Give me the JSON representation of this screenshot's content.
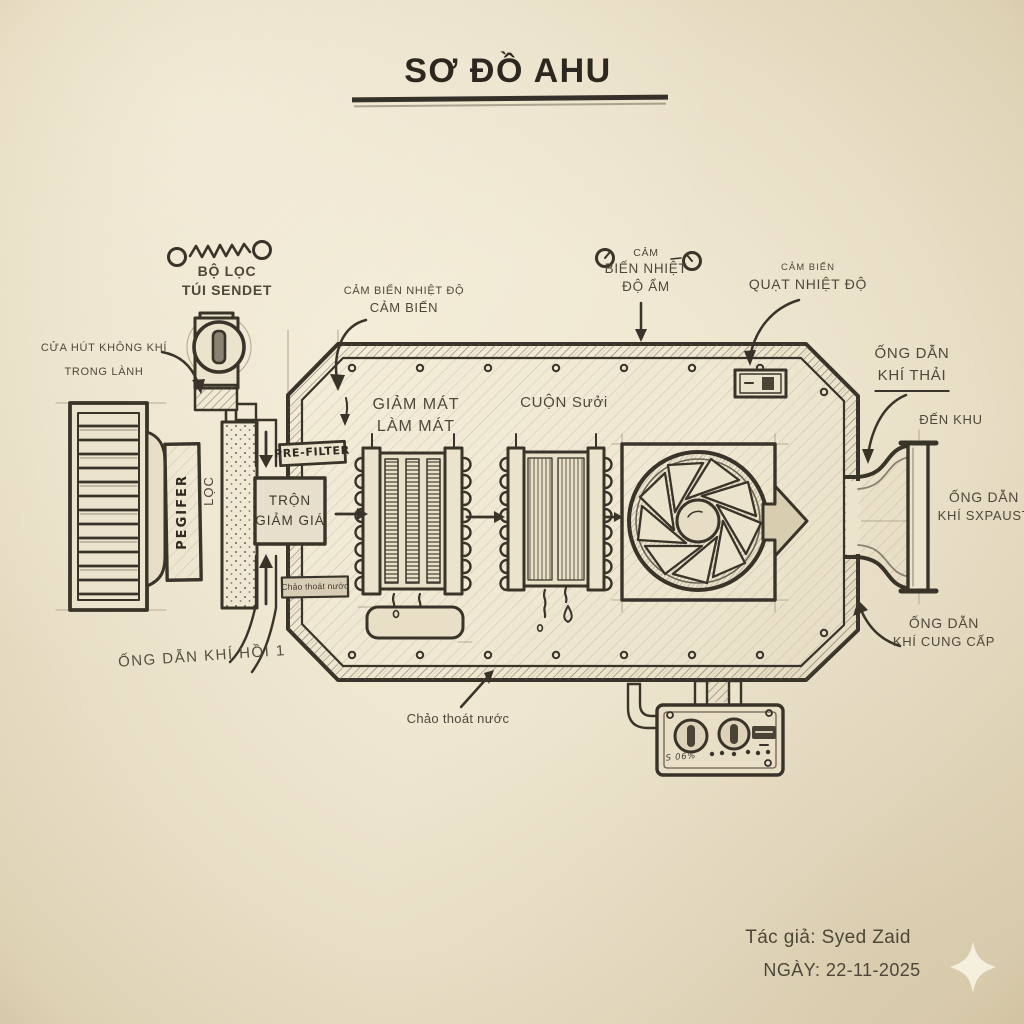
{
  "title": {
    "text": "SƠ ĐỒ AHU"
  },
  "labels": {
    "bag_filter": {
      "lines": [
        "BỘ LỌC",
        "TÚI SENDET"
      ]
    },
    "fresh_air_intake": {
      "lines": [
        "CỬA HÚT KHÔNG KHÍ",
        "TRONG LÀNH"
      ]
    },
    "temperature_sensor": {
      "lines": [
        "CẢM BIẾN NHIỆT ĐỘ",
        "CẢM BIẾN"
      ]
    },
    "humidity_sensor": {
      "lines": [
        "CẢM",
        "BIẾN NHIỆT",
        "ĐỘ ẨM"
      ]
    },
    "fan_temp_sensor": {
      "lines": [
        "CẢM BIẾN",
        "QUẠT NHIỆT ĐỘ"
      ]
    },
    "exhaust_duct": {
      "lines": [
        "ỐNG DẪN",
        "KHÍ THẢI"
      ]
    },
    "to_zone": {
      "text": "ĐẾN KHU"
    },
    "exhaust_air_duct": {
      "lines": [
        "ỐNG DẪN",
        "KHÍ SXPAUST"
      ]
    },
    "supply_air_duct": {
      "lines": [
        "ỐNG DẪN",
        "KHÍ CUNG CẤP"
      ]
    },
    "cooling_coil": {
      "lines": [
        "GIẢM MÁT",
        "LÀM MÁT"
      ]
    },
    "heating_coil": {
      "text": "CUỘN Sưởi"
    },
    "mixing_box": {
      "lines": [
        "TRỘN",
        "GIẢM GIÁ"
      ]
    },
    "pre_filter_tag": {
      "text": "PRE-FILTER"
    },
    "drain_pan_tag": {
      "text": "Chảo thoát nước"
    },
    "drain_pan": {
      "text": "Chảo thoát nước"
    },
    "return_air_duct": {
      "text": "ỐNG DẪN KHÍ HỒI 1"
    },
    "filter_panel": {
      "text": "PEGIFER"
    },
    "filter_word": {
      "text": "LỌC"
    },
    "panel_scribble": {
      "text": "S 06%"
    }
  },
  "credits": {
    "author": "Tác giả: Syed Zaid",
    "date": "NGÀY: 22-11-2025"
  },
  "colors": {
    "paper": "#ebe2ca",
    "ink": "#39342a",
    "label_text": "#4f483a"
  }
}
